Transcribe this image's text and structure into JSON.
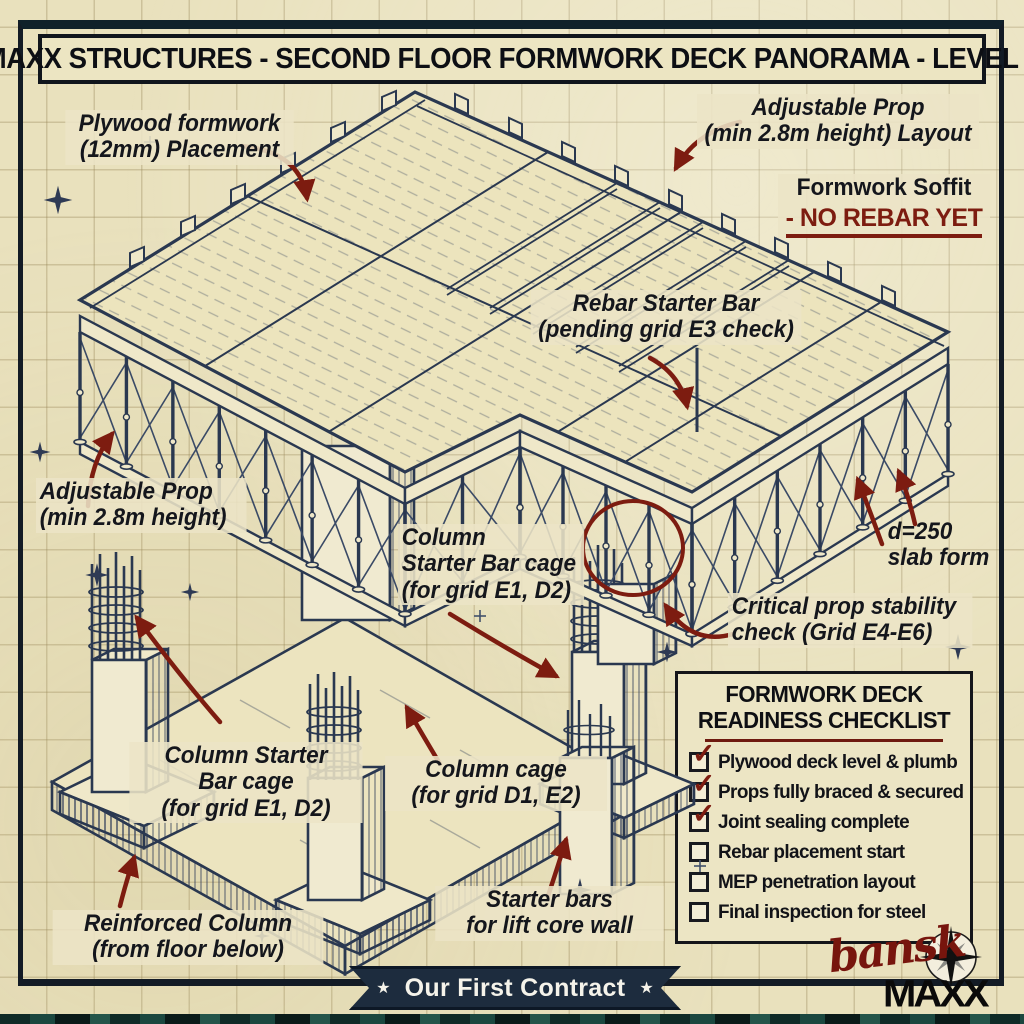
{
  "header": {
    "title": "MAXX STRUCTURES - SECOND FLOOR FORMWORK DECK PANORAMA - LEVEL 2"
  },
  "annotations": {
    "plywood": "Plywood formwork\n(12mm) Placement",
    "prop_layout": "Adjustable Prop\n(min 2.8m height) Layout",
    "soffit1": "Formwork Soffit",
    "soffit2": "- NO REBAR YET",
    "rebar_starter": "Rebar Starter Bar\n(pending grid E3 check)",
    "prop_left": "Adjustable Prop\n(min 2.8m height)",
    "column_starter_mid": "Column\nStarter Bar cage\n(for grid E1, D2)",
    "slab_form": "d=250\nslab form",
    "critical_prop": "Critical prop stability\ncheck (Grid E4-E6)",
    "column_starter_bottom": "Column Starter\nBar cage\n(for grid E1, D2)",
    "column_cage": "Column cage\n(for grid D1, E2)",
    "starter_bars": "Starter bars\nfor lift core wall",
    "reinforced_column": "Reinforced Column\n(from floor below)"
  },
  "checklist": {
    "title_line1": "FORMWORK DECK",
    "title_line2": "READINESS CHECKLIST",
    "items": [
      {
        "label": "Plywood deck level & plumb",
        "checked": true,
        "mark": "✓"
      },
      {
        "label": "Props fully braced & secured",
        "checked": true,
        "mark": "✓"
      },
      {
        "label": "Joint sealing complete",
        "checked": true,
        "mark": "✓"
      },
      {
        "label": "Rebar placement start",
        "checked": false,
        "mark": ""
      },
      {
        "label": "MEP penetration layout",
        "checked": false,
        "mark": ""
      },
      {
        "label": "Final inspection for steel",
        "checked": false,
        "mark": ""
      }
    ]
  },
  "banner": {
    "text": "Our First Contract",
    "star": "★"
  },
  "footer": {
    "signature": "bansk",
    "logo": "MAXX"
  },
  "colors": {
    "paper": "#e9e1bd",
    "ink": "#2a3850",
    "accent_red": "#7d1c10",
    "ribbon_navy": "#1d2c3e"
  }
}
